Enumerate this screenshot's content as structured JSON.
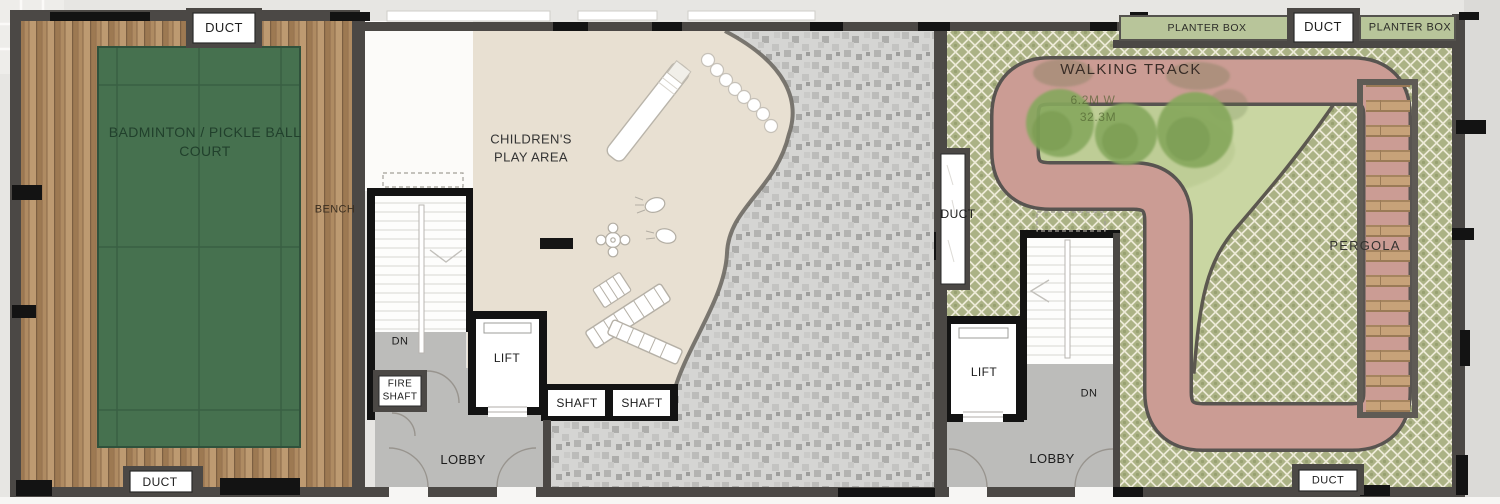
{
  "plan_labels": {
    "duct_top_left": "DUCT",
    "badminton_line1": "BADMINTON / PICKLE BALL",
    "badminton_line2": "COURT",
    "bench": "BENCH",
    "children_line1": "CHILDREN'S",
    "children_line2": "PLAY AREA",
    "dn_left": "DN",
    "fire_line1": "FIRE",
    "fire_line2": "SHAFT",
    "lift_left": "LIFT",
    "shaft_1": "SHAFT",
    "shaft_2": "SHAFT",
    "lobby_left": "LOBBY",
    "duct_bottom_left": "DUCT",
    "duct_mid": "DUCT",
    "walking_track": "WALKING TRACK",
    "track_width": "6.2M W",
    "track_length": "32.3M",
    "planter_box_left": "PLANTER BOX",
    "duct_top_right": "DUCT",
    "planter_box_right": "PLANTER BOX",
    "pergola": "PERGOLA",
    "lift_right": "LIFT",
    "dn_right": "DN",
    "lobby_right": "LOBBY",
    "duct_bottom_right": "DUCT"
  },
  "colors": {
    "exterior": "#e7e6e3",
    "wall": "#4b4845",
    "column": "#131313",
    "wood1": "#af8b62",
    "wood2": "#9d7952",
    "wood3": "#bd9a71",
    "court": "#46714f",
    "court_line": "#2f523b",
    "court_text": "#21402c",
    "beige": "#e8e0d2",
    "mosaic_base": "#d5d5d3",
    "lattice_olive": "#abb285",
    "lattice_cream": "#edead7",
    "lawn": "#c9d6a2",
    "track": "#cb9c94",
    "track_edge": "#585450",
    "pergola_slat": "#c7a279",
    "planter": "#b8c59a",
    "lobby": "#bcbcba",
    "stair_white": "#fdfdfc"
  }
}
